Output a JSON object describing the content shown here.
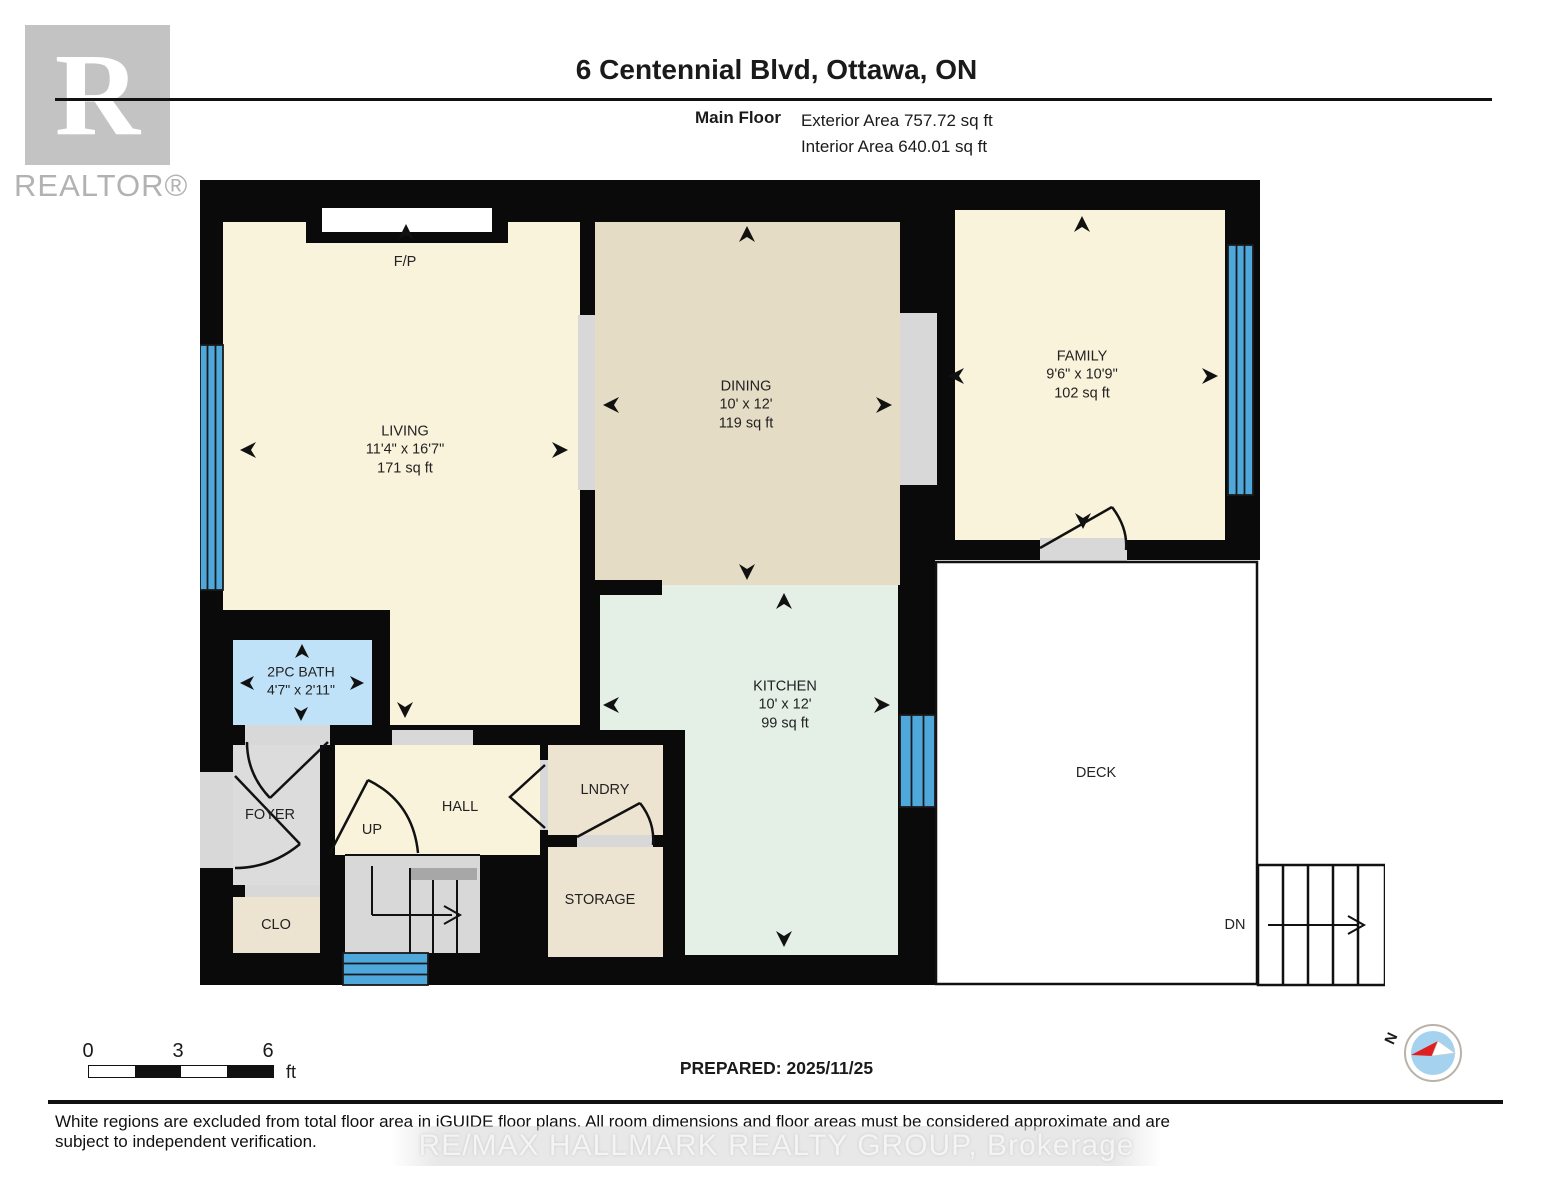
{
  "header": {
    "logo_r": "R",
    "logo_wordmark": "REALTOR®",
    "title": "6 Centennial Blvd, Ottawa, ON",
    "floor_label": "Main Floor",
    "exterior_area": "Exterior Area 757.72 sq ft",
    "interior_area": "Interior Area 640.01 sq ft"
  },
  "rooms": {
    "living": {
      "name": "LIVING",
      "dims": "11'4\" x 16'7\"",
      "area": "171 sq ft"
    },
    "dining": {
      "name": "DINING",
      "dims": "10' x 12'",
      "area": "119 sq ft"
    },
    "family": {
      "name": "FAMILY",
      "dims": "9'6\" x 10'9\"",
      "area": "102 sq ft"
    },
    "kitchen": {
      "name": "KITCHEN",
      "dims": "10' x 12'",
      "area": "99 sq ft"
    },
    "bath": {
      "name": "2PC BATH",
      "dims": "4'7\" x 2'11\""
    },
    "fireplace": "F/P",
    "foyer": "FOYER",
    "hall": "HALL",
    "up": "UP",
    "closet": "CLO",
    "laundry": "LNDRY",
    "storage": "STORAGE",
    "deck": "DECK",
    "down": "DN"
  },
  "footer": {
    "scale": {
      "t0": "0",
      "t1": "3",
      "t2": "6",
      "unit": "ft"
    },
    "prepared": "PREPARED: 2025/11/25",
    "disclaimer": "White regions are excluded from total floor area in iGUIDE floor plans. All room dimensions and floor areas must be considered approximate and are subject to independent verification.",
    "watermark": "RE/MAX HALLMARK REALTY GROUP, Brokerage",
    "compass_n": "N"
  },
  "colors": {
    "wall": "#0a0a0a",
    "room_cream": "#FAF3DC",
    "dining_tan": "#E5DCC6",
    "kitchen_green": "#E4EFE6",
    "bath_blue": "#BFE2F8",
    "window_blue": "#4FA8DC",
    "opening_gray": "#D8D8D8",
    "utility_tan": "#EDE3D1",
    "foyer_gray": "#DCDCDC"
  }
}
